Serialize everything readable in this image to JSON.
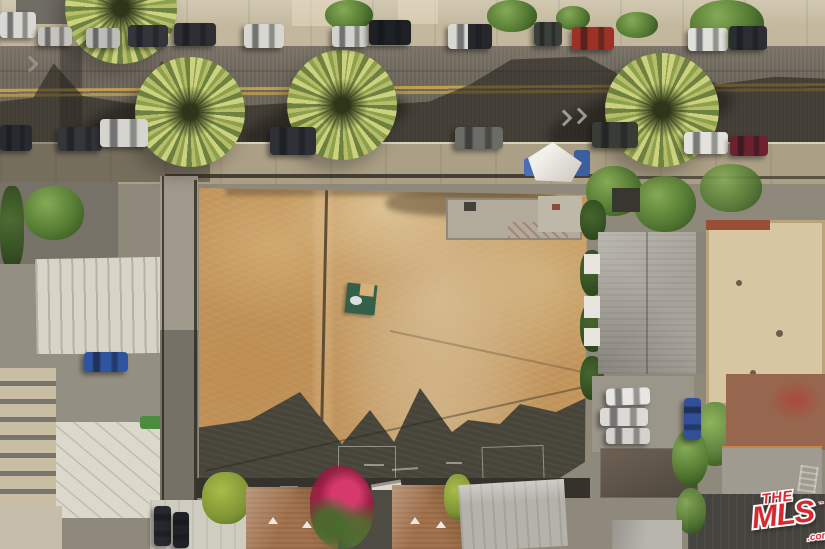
{
  "photo": {
    "kind": "aerial-drone-photograph",
    "orientation": "top-down",
    "subject": "Vacant graded dirt lot between residential buildings, bordered on top by a street with parallel-parked cars and palm trees; rooftops of neighboring houses on the left, right and bottom; gabled roof shadows cast onto the lot"
  },
  "watermark": {
    "the": "THE",
    "mls": "MLS",
    "tm": "™",
    "com": ".com",
    "color_red": "#d7282f",
    "color_outline": "#ffffff"
  },
  "palette": {
    "asphalt": "#6e675c",
    "centerline_yellow": "#c9a54b",
    "sidewalk": "#c3b89e",
    "dirt_lot": "#c2955c",
    "cast_shadow": "#474439",
    "palm_fronds": "#b6bd68",
    "tree_green": "#567c34",
    "bougainvillea": "#c2275a",
    "shingle_brown": "#a3734d",
    "roof_gray": "#a7a39a",
    "roof_tan": "#d6c6a2"
  },
  "scene_inventory": {
    "palm_trees": 4,
    "parked_cars_north_curb": 13,
    "parked_cars_south_curb": 8,
    "other_vehicles": 7,
    "canopy_tent": 1,
    "green_mat_in_lot": 1,
    "concrete_pad_in_lot": 1,
    "roof_shadow_gable_peaks": 3
  }
}
